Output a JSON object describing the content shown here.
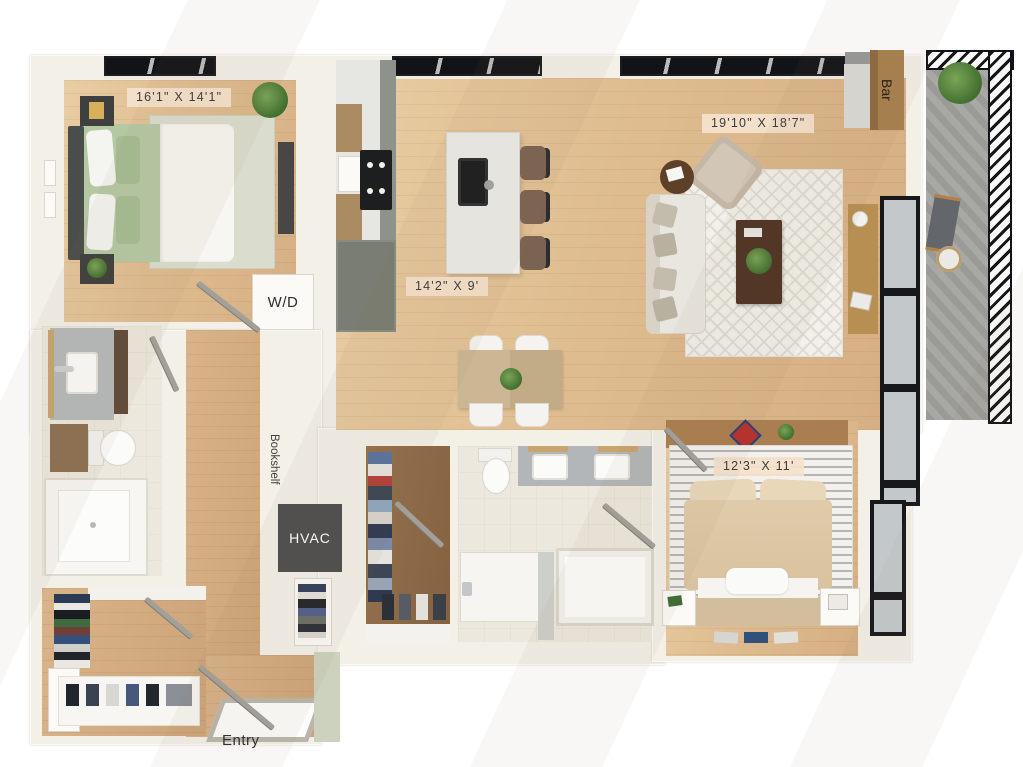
{
  "title": "3D apartment floor plan",
  "rooms": {
    "bedroom_primary": {
      "dimensions": "16'1\" X 14'1\""
    },
    "living_room": {
      "dimensions": "19'10\" X 18'7\""
    },
    "kitchen": {
      "dimensions": "14'2\" X 9'"
    },
    "bedroom_secondary": {
      "dimensions": "12'3\" X 11'"
    }
  },
  "features": {
    "washer_dryer": "W/D",
    "hvac": "HVAC",
    "bookshelf": "Bookshelf",
    "bar": "Bar",
    "entry": "Entry"
  },
  "colors": {
    "wall": "#f3f0e8",
    "floor_wood": "#dfbd91",
    "floor_tile": "#ece8dd",
    "label_background": "#f4e1cc",
    "label_text": "#3b3b3b",
    "hvac_box": "#4f4f4f",
    "balcony_deck": "#a0a09d",
    "bed_primary_green": "#b5c8a4",
    "bed_secondary_tan": "#dcc7a5",
    "closet_floor_brown": "#8d6b4e",
    "accent_red": "#b5312c",
    "plant_green": "#4e7e3c"
  }
}
